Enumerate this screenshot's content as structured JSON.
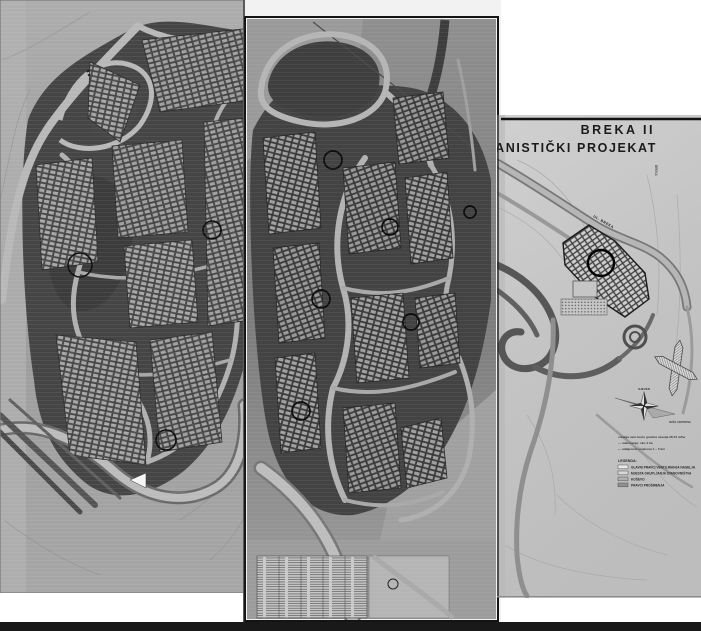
{
  "page": {
    "background_color": "#ffffff",
    "bottom_bar_color": "#191919"
  },
  "right_sheet": {
    "title_line1": "BREKA II",
    "title_line2": "URBANISTIČKI PROJEKAT",
    "street_label_diagonal": "UL. BREKA",
    "street_label_vertical": "BREKA",
    "compass": {
      "north_label": "SJEVER",
      "rose_label": "RUŽA VJETROVA"
    },
    "notes": [
      "srednja neto bruto gustina naselja 28,73 st/ha",
      "— stanovanje: oko 4 ha",
      "— udaljenost smjerova 1 – 5 km"
    ],
    "legend": {
      "heading": "LEGENDA:",
      "items": [
        {
          "label": "GLAVNI PRAVCI VENTILIRANJA NASELJA",
          "swatch": "#e8e8e8"
        },
        {
          "label": "MJESTA OKUPLJANJA STANOVNIŠTVA",
          "swatch": "#d8d8d8"
        },
        {
          "label": "KOŠEVO",
          "swatch": "#b0b0b0"
        },
        {
          "label": "PRAVCI PROŠIRENJA",
          "swatch": "#8f8f8f"
        }
      ]
    }
  },
  "colors": {
    "paper_left": "#a0a0a0",
    "paper_center": "#878787",
    "paper_right": "#c7c7c7",
    "dark_block": "#434343",
    "road_light": "#b8b8b8",
    "ink": "#111111"
  }
}
